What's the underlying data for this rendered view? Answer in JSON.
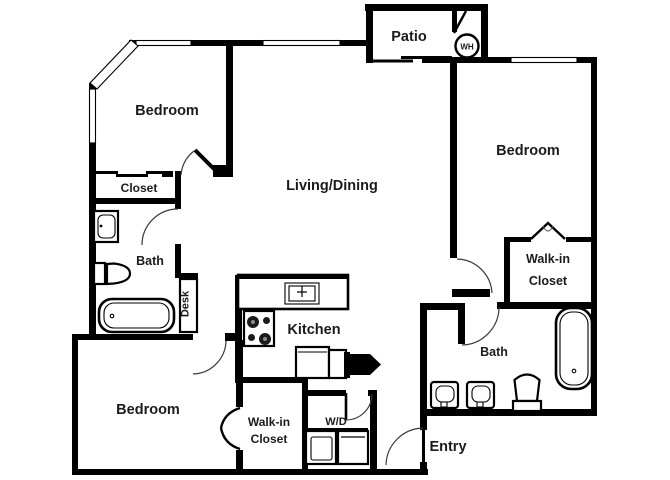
{
  "rooms": {
    "bedroom_top_left": "Bedroom",
    "closet_top_left": "Closet",
    "bath_left": "Bath",
    "desk": "Desk",
    "living_dining": "Living/Dining",
    "patio": "Patio",
    "water_heater": "WH",
    "bedroom_right": "Bedroom",
    "walk_in_closet_right_line1": "Walk-in",
    "walk_in_closet_right_line2": "Closet",
    "bath_right": "Bath",
    "kitchen": "Kitchen",
    "bedroom_bottom": "Bedroom",
    "walk_in_closet_bottom_line1": "Walk-in",
    "walk_in_closet_bottom_line2": "Closet",
    "laundry": "W/D",
    "entry": "Entry"
  },
  "colors": {
    "wall": "#000000",
    "floor": "#ffffff",
    "label": "#1b1b1b"
  }
}
